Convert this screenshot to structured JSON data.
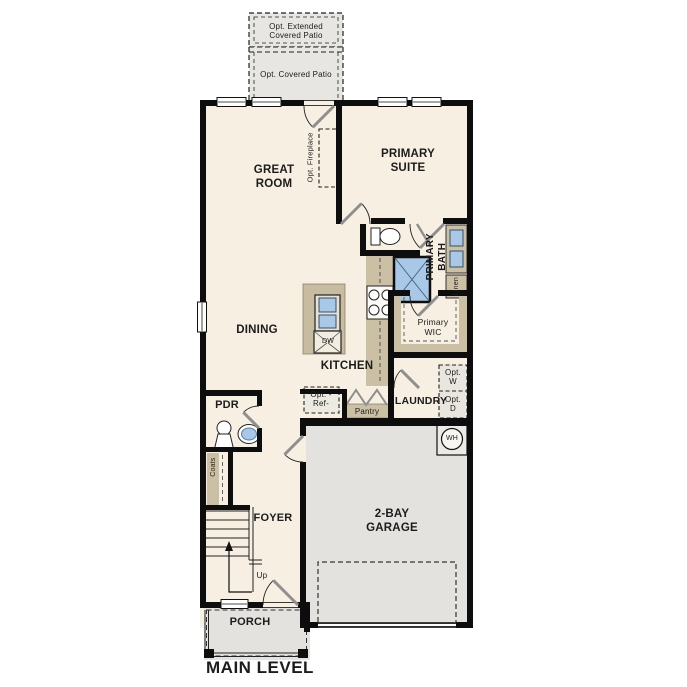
{
  "plan_title": "MAIN LEVEL",
  "colors": {
    "floor": "#f6efe2",
    "hard_surface_gray": "#e3e2df",
    "counter_tan": "#ccc0a4",
    "fixture_blue": "#a9c7e6",
    "wall_black": "#0d0d0d"
  },
  "labels": {
    "opt_extended_patio": "Opt. Extended Covered Patio",
    "opt_covered_patio": "Opt. Covered Patio",
    "great_room": "GREAT ROOM",
    "primary_suite": "PRIMARY SUITE",
    "opt_fireplace": "Opt. Fireplace",
    "primary_bath": "PRIMARY BATH",
    "linen": "Linen",
    "primary_wic": "Primary WIC",
    "dining": "DINING",
    "kitchen": "KITCHEN",
    "dishwasher": "DW",
    "opt_ref": "Opt. -Ref-",
    "pantry": "Pantry",
    "laundry": "LAUNDRY",
    "opt_washer": "Opt. W",
    "opt_dryer": "Opt. D",
    "water_heater": "WH",
    "pdr": "PDR",
    "coats": "Coats",
    "foyer": "FOYER",
    "stairs_up": "Up",
    "garage": "2-BAY GARAGE",
    "porch": "PORCH",
    "main_level": "MAIN LEVEL"
  }
}
